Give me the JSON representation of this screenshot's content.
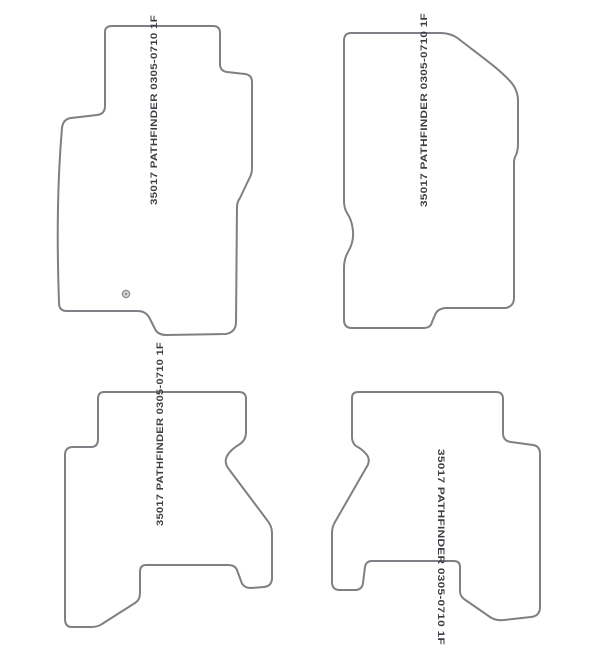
{
  "colors": {
    "background": "#ffffff",
    "outline": "#7d8084",
    "label": "#3b3f45"
  },
  "mats": [
    {
      "id": "front-left",
      "position": "top-left",
      "label": "35017 PATHFINDER 0305-0710 1F"
    },
    {
      "id": "front-right",
      "position": "top-right",
      "label": "35017 PATHFINDER 0305-0710 1F"
    },
    {
      "id": "rear-left",
      "position": "bottom-left",
      "label": "35017 PATHFINDER 0305-0710 1F"
    },
    {
      "id": "rear-right",
      "position": "bottom-right",
      "label": "35017 PATHFINDER 0305-0710 1F"
    }
  ]
}
